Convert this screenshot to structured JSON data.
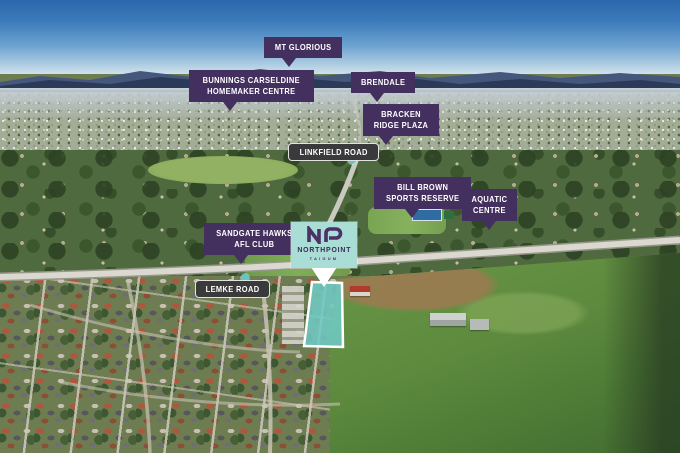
{
  "flags": [
    {
      "id": "mt-glorious",
      "lines": [
        "MT GLORIOUS"
      ]
    },
    {
      "id": "bunnings-carseldine",
      "lines": [
        "BUNNINGS CARSELDINE",
        "HOMEMAKER CENTRE"
      ]
    },
    {
      "id": "brendale",
      "lines": [
        "BRENDALE"
      ]
    },
    {
      "id": "bracken-ridge-plaza",
      "lines": [
        "BRACKEN",
        "RIDGE PLAZA"
      ]
    },
    {
      "id": "bill-brown-sports",
      "lines": [
        "BILL BROWN",
        "SPORTS RESERVE"
      ]
    },
    {
      "id": "aquatic-centre",
      "lines": [
        "AQUATIC",
        "CENTRE"
      ]
    },
    {
      "id": "sandgate-hawks",
      "lines": [
        "SANDGATE HAWKS",
        "AFL CLUB"
      ]
    }
  ],
  "road_signs": [
    {
      "id": "linkfield-road",
      "label": "LINKFIELD ROAD"
    },
    {
      "id": "lemke-road",
      "label": "LEMKE ROAD"
    }
  ],
  "site_sign": {
    "brand": "NORTHPOINT",
    "suburb": "TAIGUM",
    "logo": "np-monogram"
  },
  "colors": {
    "flag_purple": "#44305f",
    "pill_charcoal": "#3a3a3c",
    "marker_teal": "#5fc8c4",
    "sign_mint": "#a9ddd6",
    "brand_purple": "#4a3166",
    "site_overlay_fill": "#6fcac3",
    "site_overlay_border": "#ffffff",
    "sky_blue": "#2a67ad",
    "mountain_navy": "#2b3a58"
  }
}
